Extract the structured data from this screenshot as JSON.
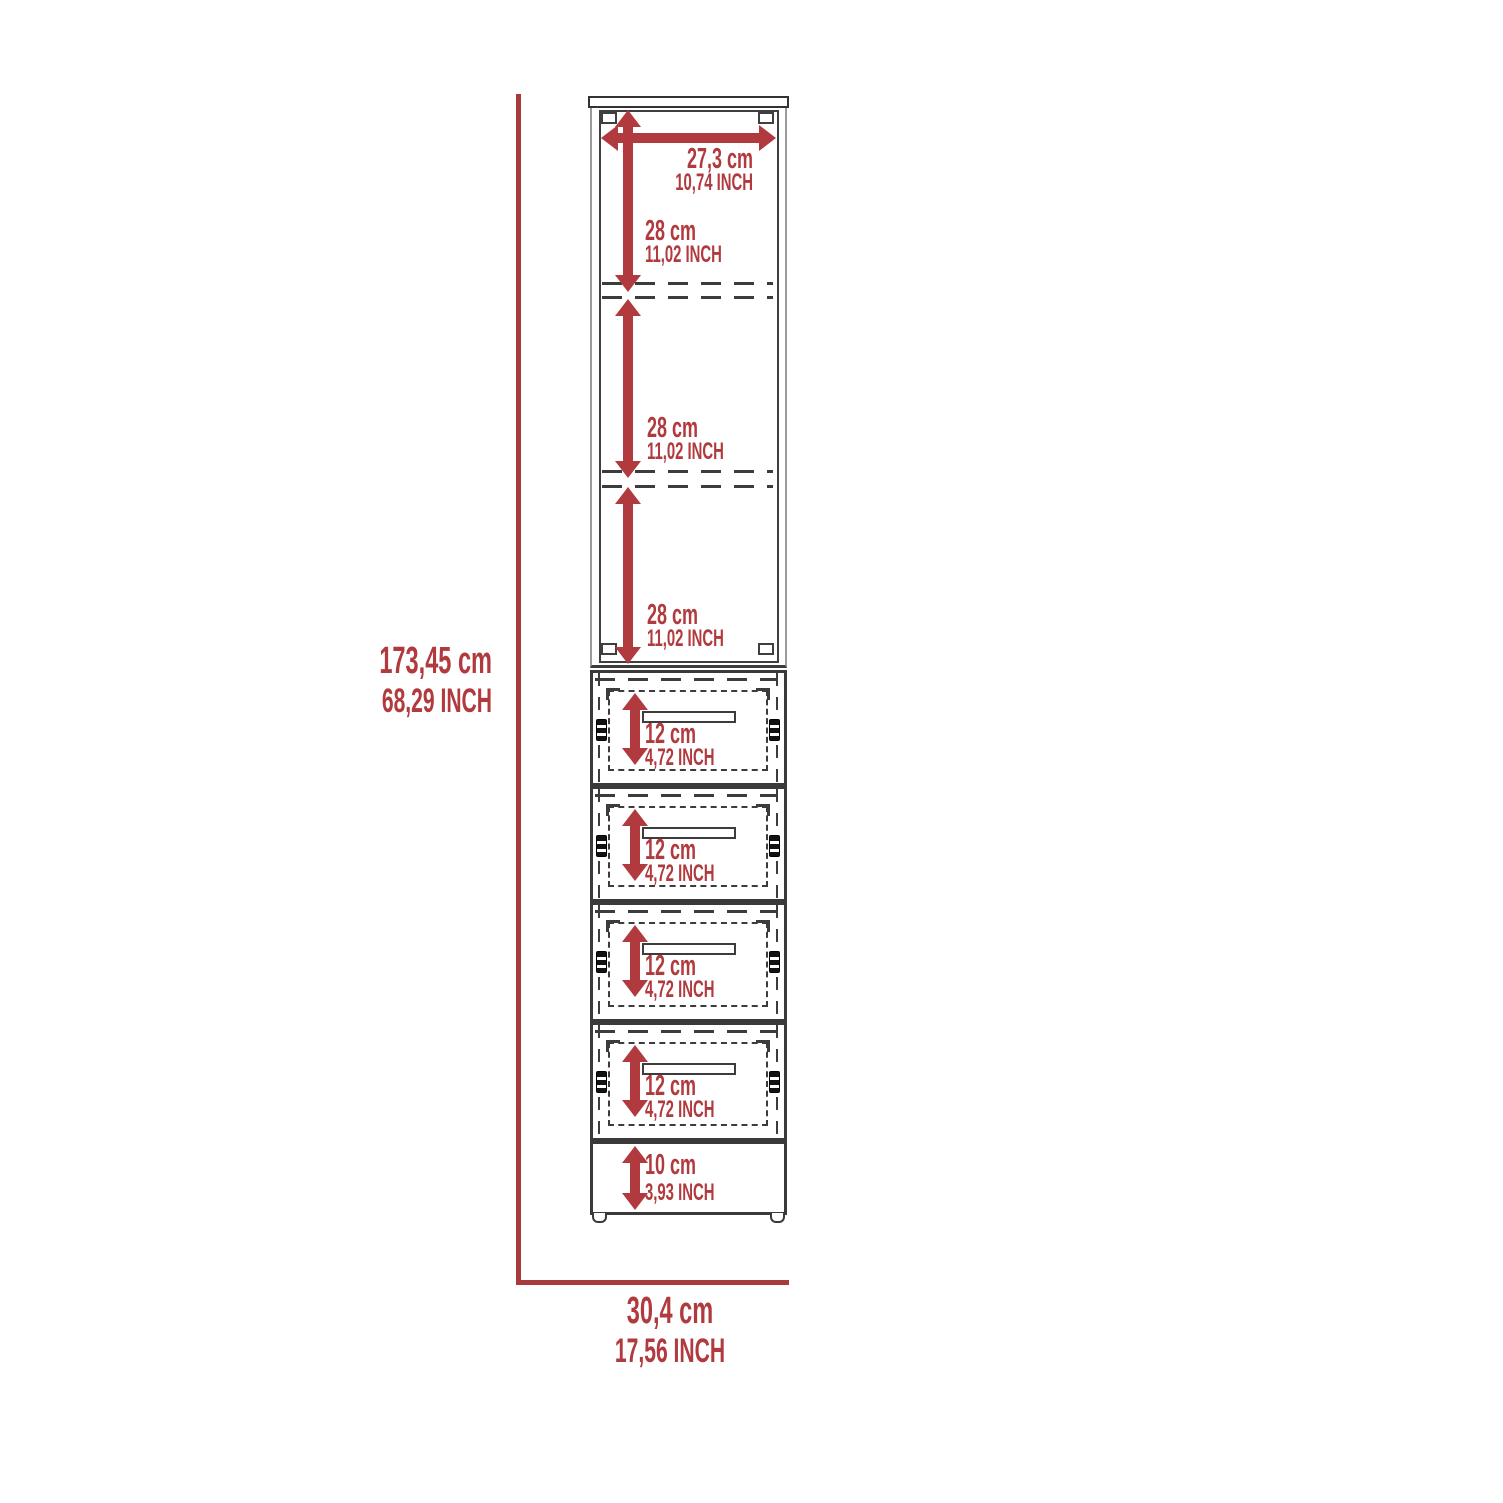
{
  "diagram": {
    "type": "furniture-dimension-diagram",
    "overall_height": {
      "cm": "173,45 cm",
      "inch": "68,29 INCH"
    },
    "overall_width": {
      "cm": "30,4 cm",
      "inch": "17,56 INCH"
    },
    "interior_width": {
      "cm": "27,3 cm",
      "inch": "10,74 INCH"
    },
    "shelf_sections": [
      {
        "cm": "28 cm",
        "inch": "11,02 INCH"
      },
      {
        "cm": "28 cm",
        "inch": "11,02 INCH"
      },
      {
        "cm": "28 cm",
        "inch": "11,02 INCH"
      }
    ],
    "drawers": [
      {
        "cm": "12 cm",
        "inch": "4,72 INCH"
      },
      {
        "cm": "12 cm",
        "inch": "4,72 INCH"
      },
      {
        "cm": "12 cm",
        "inch": "4,72 INCH"
      },
      {
        "cm": "12 cm",
        "inch": "4,72 INCH"
      }
    ],
    "base": {
      "cm": "10 cm",
      "inch": "3,93 INCH"
    },
    "colors": {
      "dimension_red": "#b13a3e",
      "outline_dark": "#3c3c3c",
      "outline_gray": "#9a9a9a",
      "background": "#ffffff"
    }
  }
}
